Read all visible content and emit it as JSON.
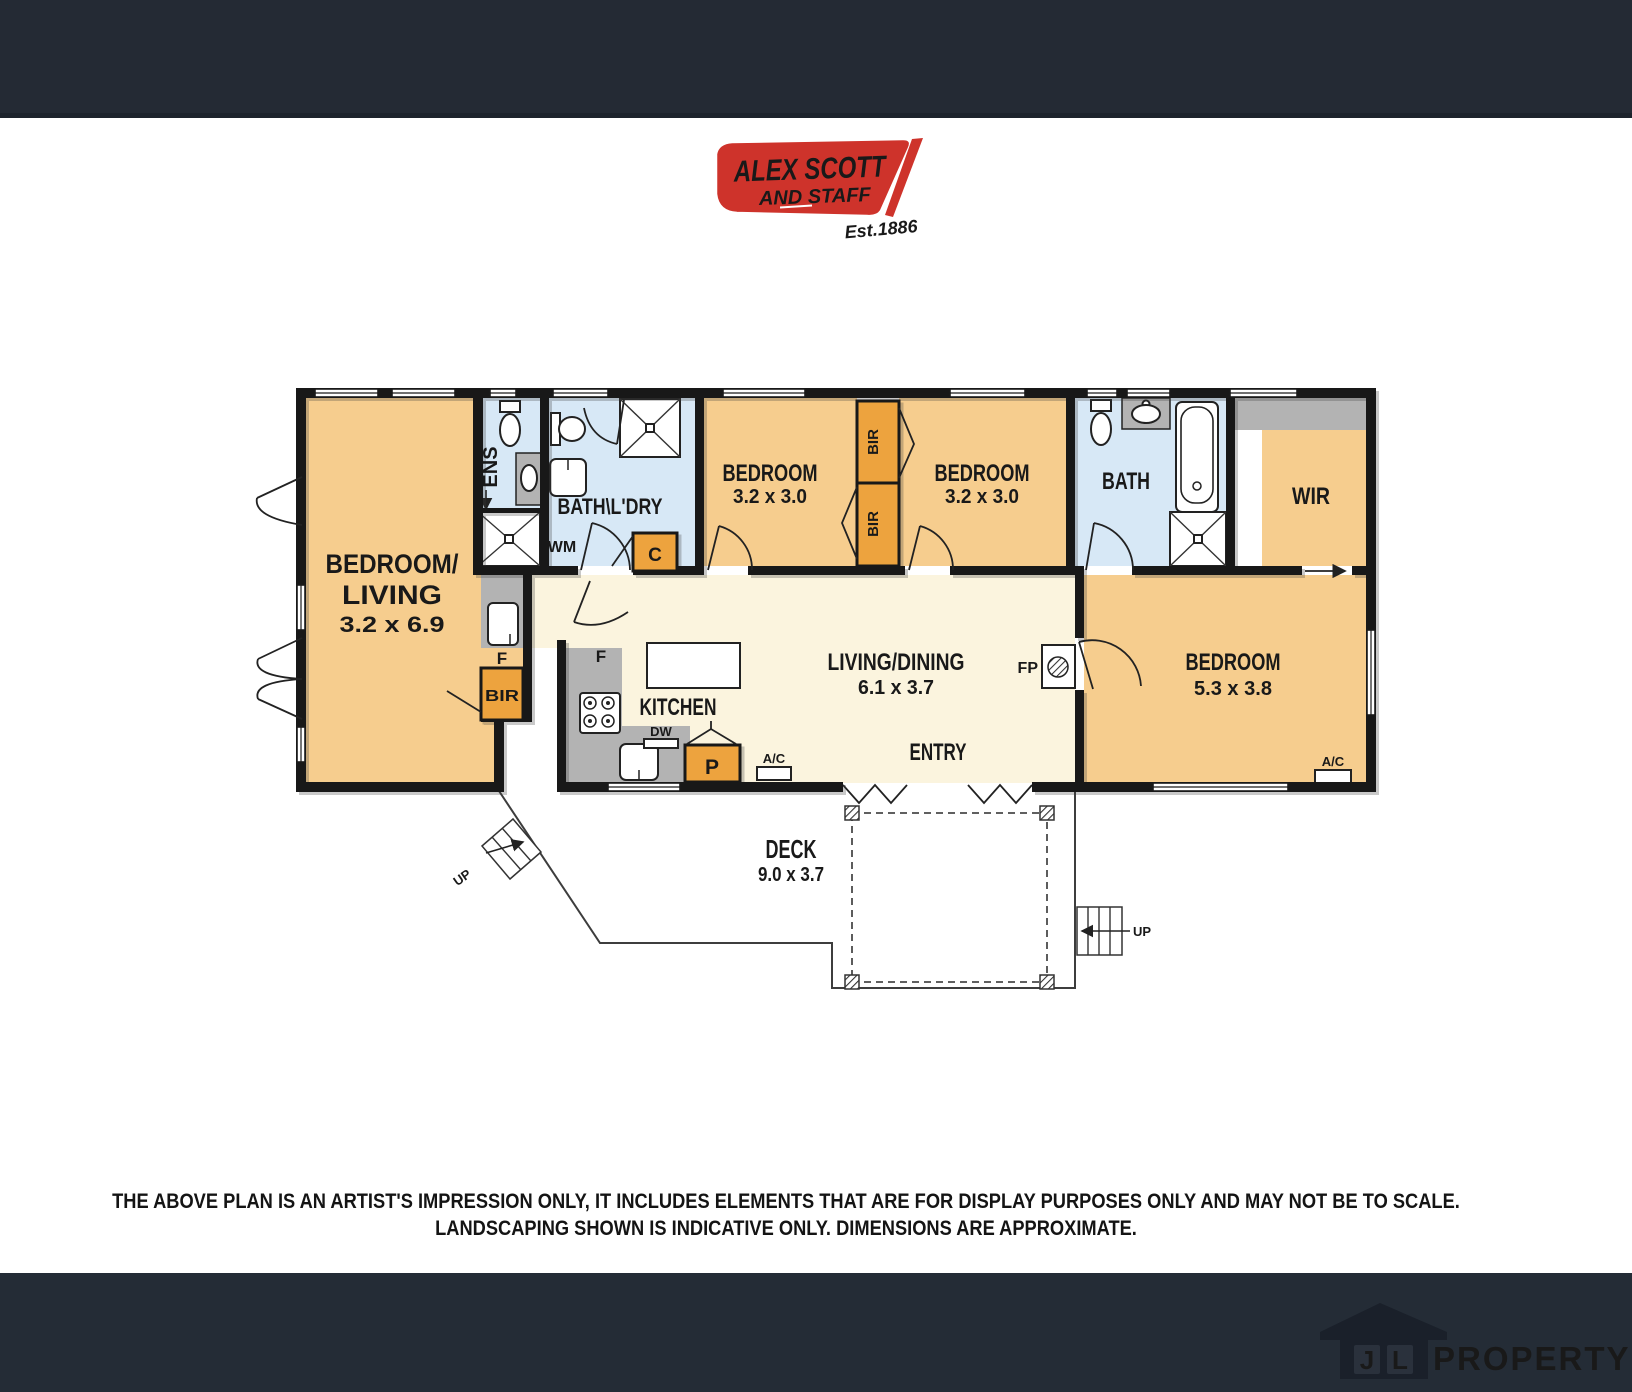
{
  "brand": {
    "name_line1": "ALEX SCOTT",
    "name_line2_and": "AND",
    "name_line2_staff": "STAFF",
    "est": "Est.1886",
    "logo_red": "#CE332B"
  },
  "plan": {
    "rooms": {
      "bedroom_living": {
        "label1": "BEDROOM/",
        "label2": "LIVING",
        "dims": "3.2 x 6.9"
      },
      "ens": {
        "label": "ENS"
      },
      "bath_ldry": {
        "label": "BATH\\L'DRY",
        "wm": "WM"
      },
      "bedroom1": {
        "label": "BEDROOM",
        "dims": "3.2 x 3.0"
      },
      "bedroom2": {
        "label": "BEDROOM",
        "dims": "3.2 x 3.0"
      },
      "bath": {
        "label": "BATH"
      },
      "wir": {
        "label": "WIR"
      },
      "bedroom3": {
        "label": "BEDROOM",
        "dims": "5.3 x 3.8"
      },
      "living_dining": {
        "label": "LIVING/DINING",
        "dims": "6.1 x 3.7"
      },
      "kitchen": {
        "label": "KITCHEN"
      },
      "entry": {
        "label": "ENTRY"
      },
      "deck": {
        "label": "DECK",
        "dims": "9.0 x 3.7"
      }
    },
    "fixtures": {
      "bir": "BIR",
      "c": "C",
      "p": "P",
      "f": "F",
      "dw": "DW",
      "ac": "A/C",
      "fp": "FP",
      "up": "UP"
    },
    "colors": {
      "room_orange": "#F6CD8E",
      "cupboard_orange": "#EDA33E",
      "wet_blue": "#D7E8F6",
      "living_cream": "#FBF4DE",
      "hall_gray": "#B3B3B3",
      "wall_black": "#181818"
    }
  },
  "disclaimer": {
    "line1": "THE ABOVE PLAN IS AN ARTIST'S IMPRESSION ONLY, IT INCLUDES ELEMENTS THAT ARE FOR DISPLAY PURPOSES ONLY AND MAY NOT BE TO SCALE.",
    "line2": "LANDSCAPING SHOWN IS INDICATIVE ONLY. DIMENSIONS ARE APPROXIMATE."
  },
  "watermark": {
    "j": "J",
    "l": "L",
    "text": "PROPERTY"
  }
}
